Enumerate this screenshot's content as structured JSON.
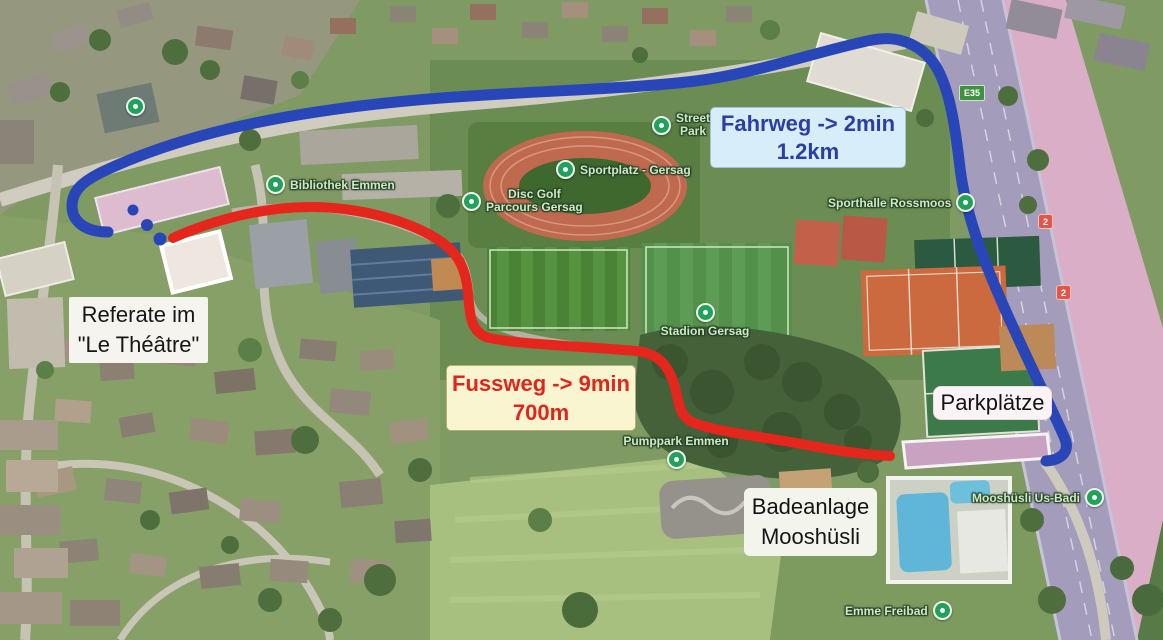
{
  "colors": {
    "drive_route": "#2946b8",
    "walk_route": "#e5261d",
    "drive_box_bg": "#d8edfa",
    "drive_box_text": "#2b3da6",
    "walk_box_bg": "#faf5d1",
    "walk_box_text": "#e3241b",
    "poi_pin": "#21a15a"
  },
  "annotations": {
    "drive": {
      "line1": "Fahrweg -> 2min",
      "line2": "1.2km"
    },
    "walk": {
      "line1": "Fussweg -> 9min",
      "line2": "700m"
    },
    "venue": {
      "line1": "Referate im",
      "line2": "\"Le Théâtre\""
    },
    "parking": {
      "label": "Parkplätze"
    },
    "pool": {
      "line1": "Badeanlage",
      "line2": "Mooshüsli"
    }
  },
  "pois": {
    "bibliothek": {
      "label": "Bibliothek Emmen"
    },
    "disc_golf": {
      "line1": "Disc Golf",
      "line2": "Parcours Gersag"
    },
    "sportplatz": {
      "label": "Sportplatz - Gersag"
    },
    "street_park": {
      "line1": "Street",
      "line2": "Park"
    },
    "sporthalle": {
      "label": "Sporthalle Rossmoos"
    },
    "stadion": {
      "label": "Stadion Gersag"
    },
    "pumppark": {
      "label": "Pumppark Emmen"
    },
    "us_badi": {
      "label": "Mooshüsli Us-Badi"
    },
    "freibad": {
      "label": "Emme Freibad"
    }
  },
  "road_badges": {
    "motorway": "E35",
    "route_north": "2",
    "route_south": "2"
  }
}
